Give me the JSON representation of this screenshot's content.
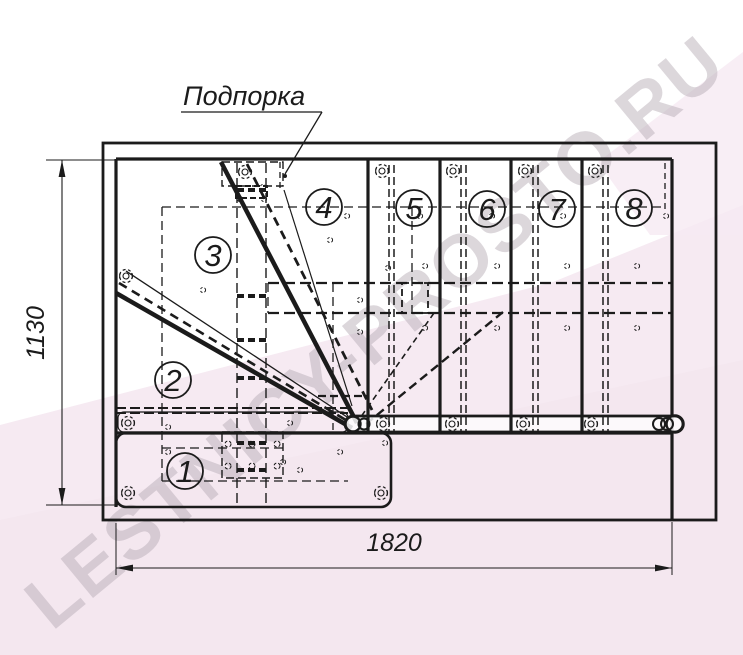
{
  "drawing": {
    "callout_label": "Подпорка",
    "dimensions": {
      "width_label": "1820",
      "height_label": "1130"
    },
    "steps": [
      {
        "label": "1"
      },
      {
        "label": "2"
      },
      {
        "label": "3"
      },
      {
        "label": "4"
      },
      {
        "label": "5"
      },
      {
        "label": "6"
      },
      {
        "label": "7"
      },
      {
        "label": "8"
      }
    ]
  },
  "watermark": {
    "text": "LESTNICY-PROSTO.RU"
  },
  "colors": {
    "line": "#1b1b1b",
    "wash_pink": "#f6eaf2",
    "wash_pink_deep": "#f2e4ec",
    "watermark_gray": "#b7acb6"
  }
}
